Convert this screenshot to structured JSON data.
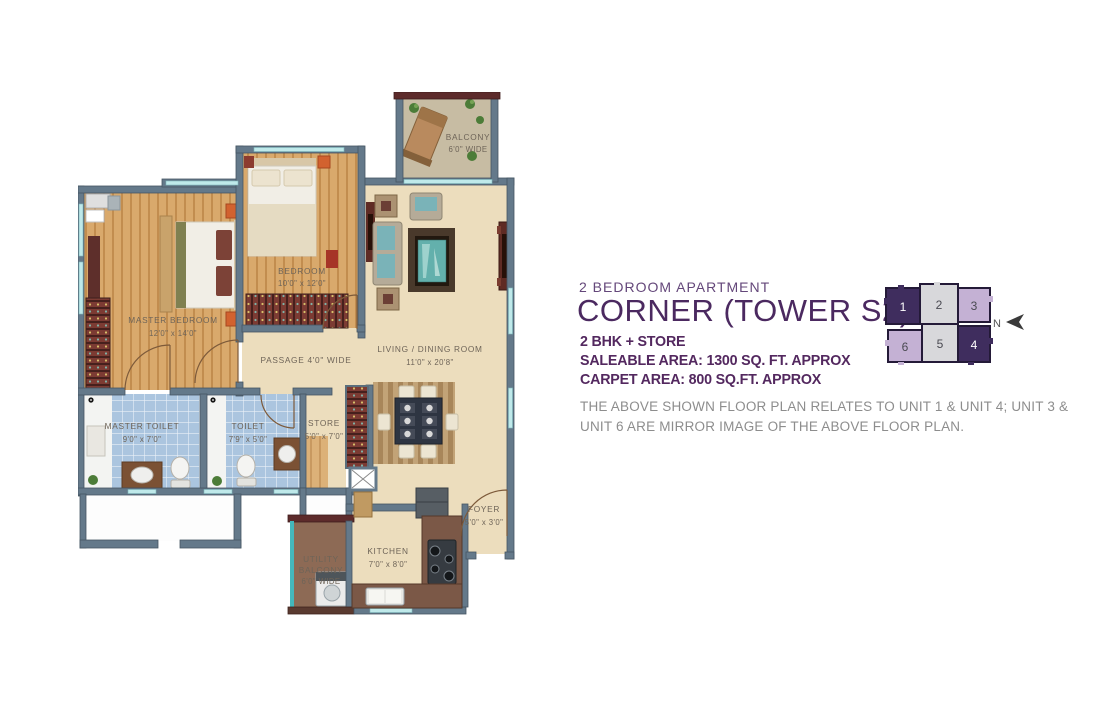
{
  "header": {
    "subtitle": "2 BEDROOM APARTMENT",
    "title": "CORNER (TOWER S2)",
    "spec_line1": "2 BHK + STORE",
    "spec_line2": "SALEABLE AREA: 1300 SQ. FT. APPROX",
    "spec_line3": "CARPET AREA: 800 SQ.FT. APPROX",
    "note_line1": "THE ABOVE SHOWN FLOOR PLAN RELATES TO UNIT 1 & UNIT 4; UNIT 3 &",
    "note_line2": "UNIT 6 ARE MIRROR IMAGE OF THE ABOVE FLOOR PLAN."
  },
  "keyplan": {
    "north_label": "N",
    "units": [
      {
        "number": "1",
        "shade": "dark"
      },
      {
        "number": "2",
        "shade": "gray"
      },
      {
        "number": "3",
        "shade": "light"
      },
      {
        "number": "6",
        "shade": "light"
      },
      {
        "number": "5",
        "shade": "gray"
      },
      {
        "number": "4",
        "shade": "dark"
      }
    ]
  },
  "plan": {
    "master_bedroom": {
      "name": "MASTER BEDROOM",
      "size": "12'0\" x 14'0\""
    },
    "bedroom": {
      "name": "BEDROOM",
      "size": "10'0\" x 12'0\""
    },
    "living_dining": {
      "name": "LIVING / DINING ROOM",
      "size": "11'0\" x 20'8\""
    },
    "balcony": {
      "name": "BALCONY",
      "size": "6'0\" WIDE"
    },
    "passage": {
      "name": "PASSAGE 4'0\" WIDE"
    },
    "master_toilet": {
      "name": "MASTER TOILET",
      "size": "9'0\" x 7'0\""
    },
    "toilet": {
      "name": "TOILET",
      "size": "7'9\" x 5'0\""
    },
    "store": {
      "name": "STORE",
      "size": "5'0\" x 7'0\""
    },
    "utility_balcony": {
      "line1": "UTILITY",
      "line2": "BALCONY",
      "line3": "6'0\" WIDE"
    },
    "kitchen": {
      "name": "KITCHEN",
      "size": "7'0\" x 8'0\""
    },
    "foyer": {
      "name": "FOYER",
      "size": "5'0\" x 3'0\""
    }
  },
  "colors": {
    "title_purple": "#4b2960",
    "subtitle_purple": "#64477a",
    "spec_purple": "#53285f",
    "note_gray": "#8d8d8d",
    "wall_gray": "#64798a",
    "wood_floor": "#d9a96c",
    "cream_floor": "#ecddbd",
    "tile_blue": "#abc5df",
    "balcony_sand": "#c7bca3",
    "accent_maroon": "#5d2b2b",
    "accent_orange": "#d2622f",
    "accent_teal": "#6fb3b0",
    "window_aqua": "#bfe9ea",
    "keyplan_dark": "#3f2d5e",
    "keyplan_light": "#c4b1d4",
    "keyplan_gray": "#d8d8db"
  }
}
